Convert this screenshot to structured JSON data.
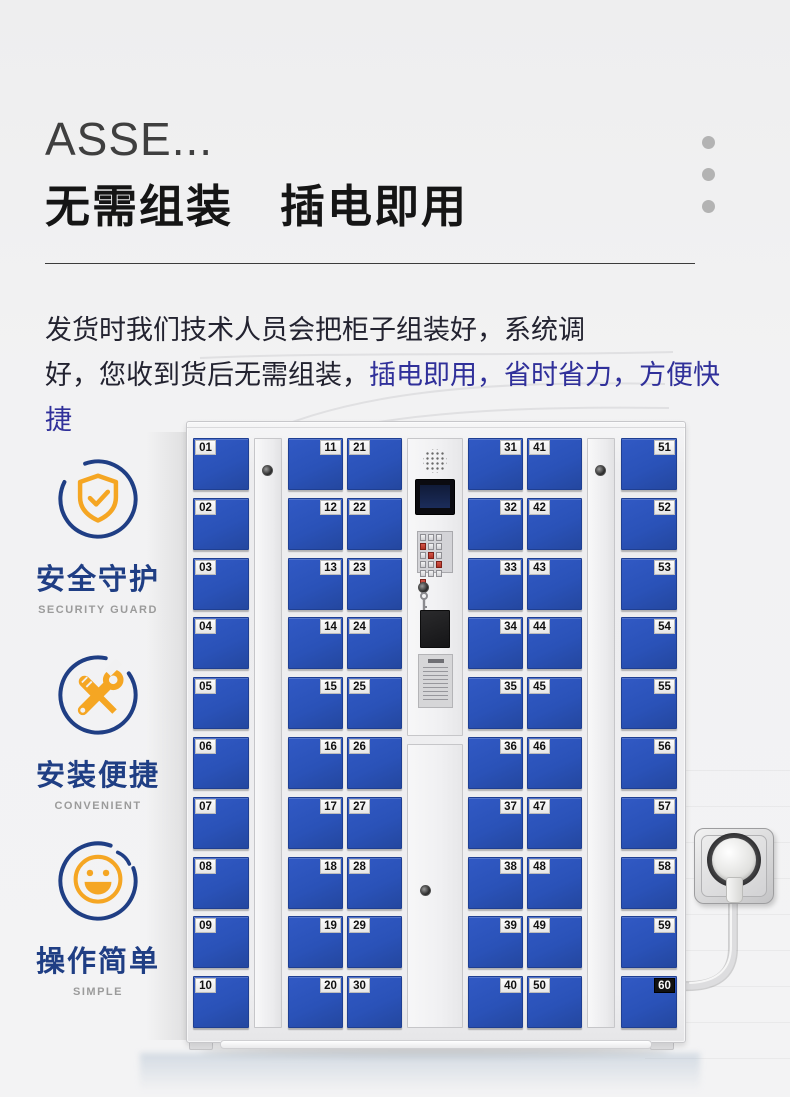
{
  "colors": {
    "accent": "#30309a",
    "door": "#2a52b8",
    "icon_navy": "#1f3e84",
    "icon_orange": "#f5a623"
  },
  "header": {
    "brand": "ASSE...",
    "title": "无需组装　插电即用"
  },
  "description": {
    "line1": "发货时我们技术人员会把柜子组装好，系统调",
    "line2_plain": "好，您收到货后无需组装，",
    "line2_accent": "插电即用，省时省力，方便快捷"
  },
  "features": [
    {
      "zh": "安全守护",
      "en": "SECURITY GUARD",
      "icon": "shield-check-icon"
    },
    {
      "zh": "安装便捷",
      "en": "CONVENIENT",
      "icon": "tools-icon"
    },
    {
      "zh": "操作简单",
      "en": "SIMPLE",
      "icon": "smiley-icon"
    }
  ],
  "locker": {
    "door_columns": [
      {
        "label_side": "left",
        "numbers": [
          "01",
          "02",
          "03",
          "04",
          "05",
          "06",
          "07",
          "08",
          "09",
          "10"
        ]
      },
      {
        "label_side": "right",
        "numbers": [
          "11",
          "12",
          "13",
          "14",
          "15",
          "16",
          "17",
          "18",
          "19",
          "20"
        ]
      },
      {
        "label_side": "left",
        "numbers": [
          "21",
          "22",
          "23",
          "24",
          "25",
          "26",
          "27",
          "28",
          "29",
          "30"
        ]
      },
      {
        "label_side": "right",
        "numbers": [
          "31",
          "32",
          "33",
          "34",
          "35",
          "36",
          "37",
          "38",
          "39",
          "40"
        ]
      },
      {
        "label_side": "left",
        "numbers": [
          "41",
          "42",
          "43",
          "44",
          "45",
          "46",
          "47",
          "48",
          "49",
          "50"
        ]
      },
      {
        "label_side": "right",
        "numbers": [
          "51",
          "52",
          "53",
          "54",
          "55",
          "56",
          "57",
          "58",
          "59",
          "60"
        ]
      }
    ],
    "inverted_plates": [
      "60"
    ]
  }
}
